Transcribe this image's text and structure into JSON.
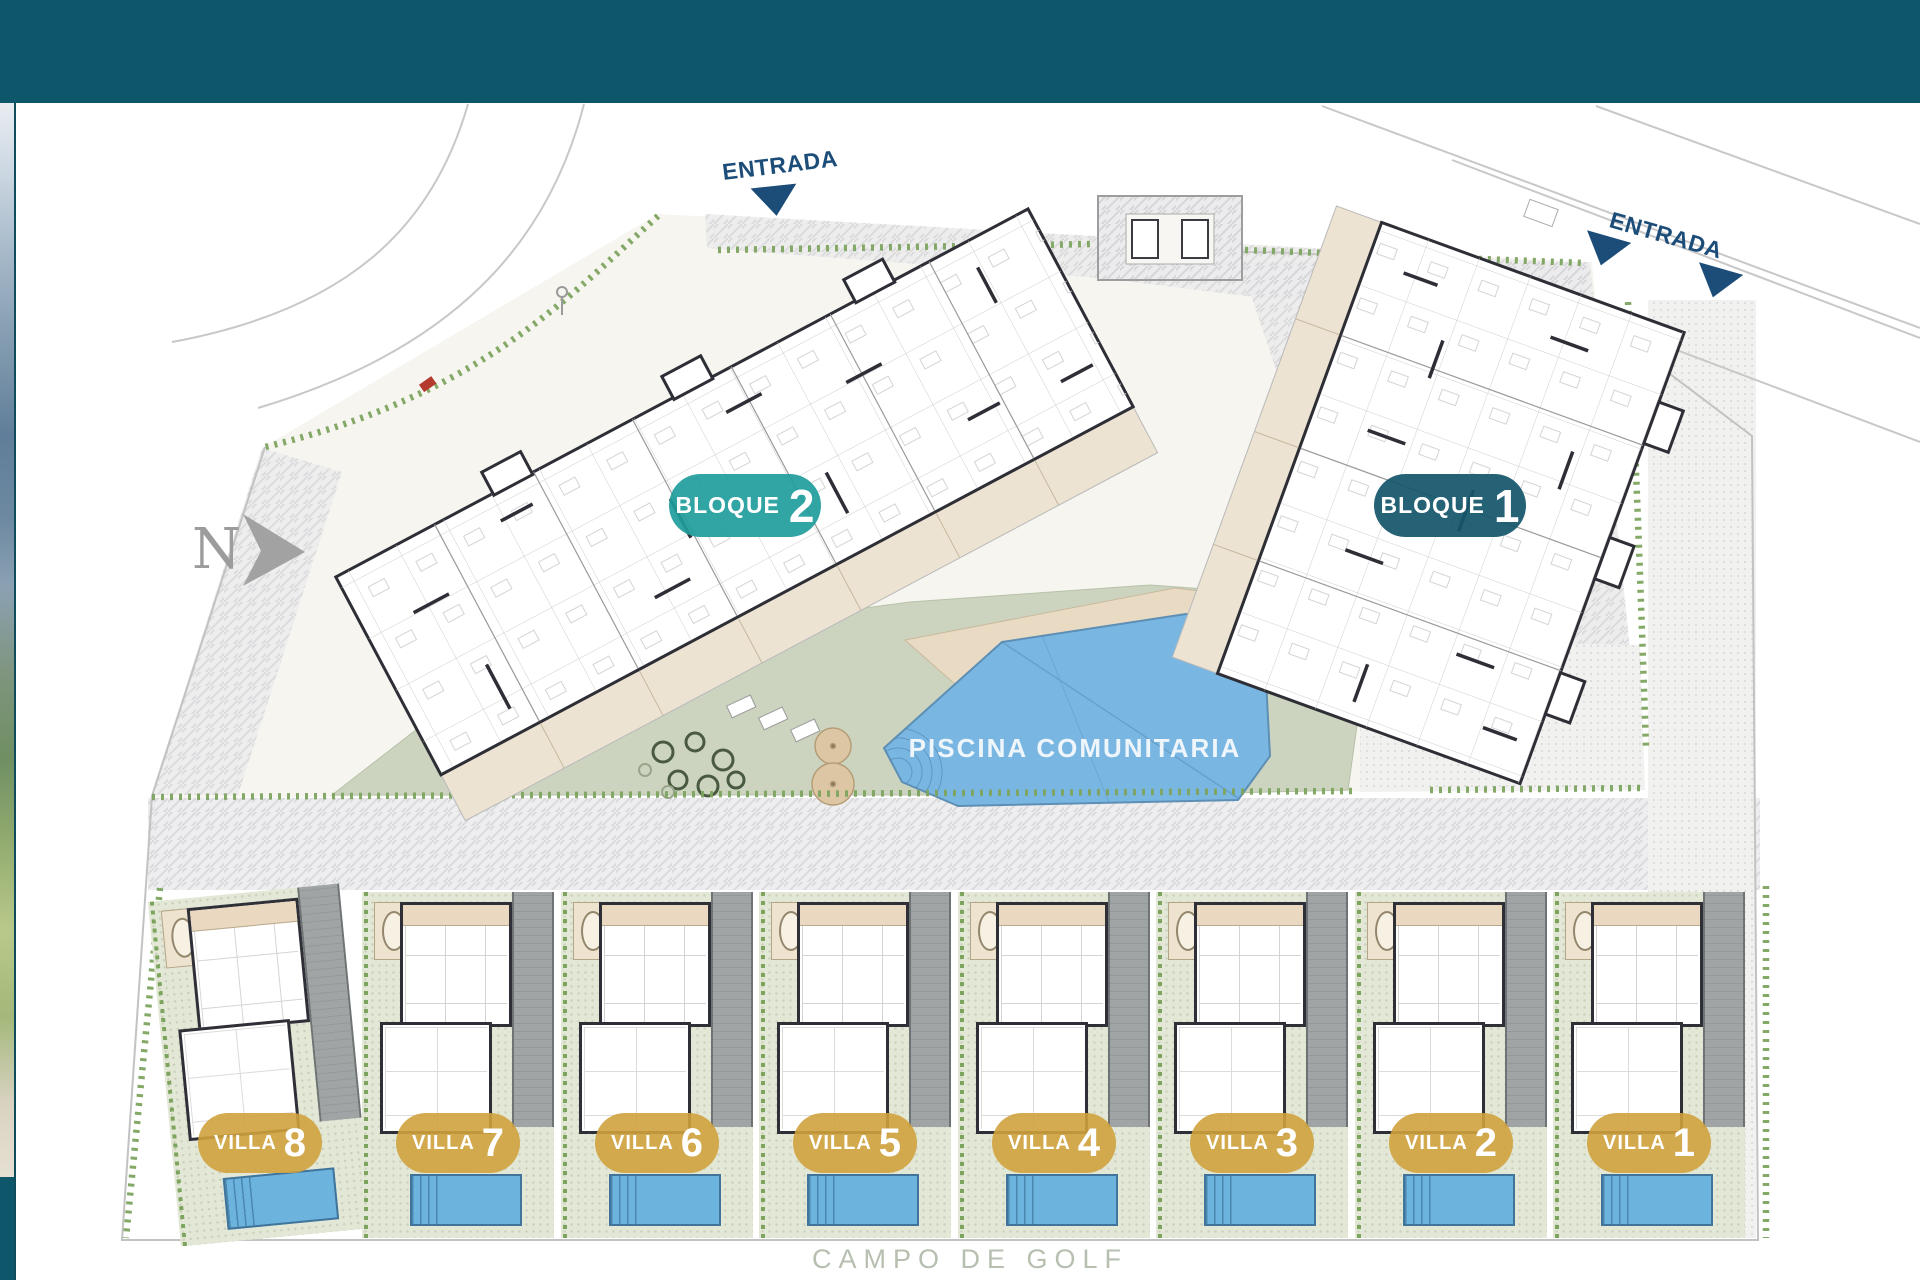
{
  "compass": {
    "label": "N"
  },
  "entrance_top": {
    "label": "ENTRADA"
  },
  "entrance_right": {
    "label": "ENTRADA"
  },
  "blocks": [
    {
      "label": "BLOQUE",
      "number": "2",
      "badge_color": "#1f9c9c"
    },
    {
      "label": "BLOQUE",
      "number": "1",
      "badge_color": "#15566c"
    }
  ],
  "pool": {
    "label": "PISCINA COMUNITARIA",
    "water_color": "#79b7e2"
  },
  "villas": [
    {
      "label": "VILLA",
      "number": "8"
    },
    {
      "label": "VILLA",
      "number": "7"
    },
    {
      "label": "VILLA",
      "number": "6"
    },
    {
      "label": "VILLA",
      "number": "5"
    },
    {
      "label": "VILLA",
      "number": "4"
    },
    {
      "label": "VILLA",
      "number": "3"
    },
    {
      "label": "VILLA",
      "number": "2"
    },
    {
      "label": "VILLA",
      "number": "1"
    }
  ],
  "footer": {
    "label": "CAMPO DE GOLF"
  },
  "colors": {
    "header_bar": "#0e5669",
    "villa_badge": "#d0a23e",
    "entrance_text": "#1c4d79",
    "hedge_green": "#7da45f",
    "lawn_green": "#ccd4bf"
  }
}
